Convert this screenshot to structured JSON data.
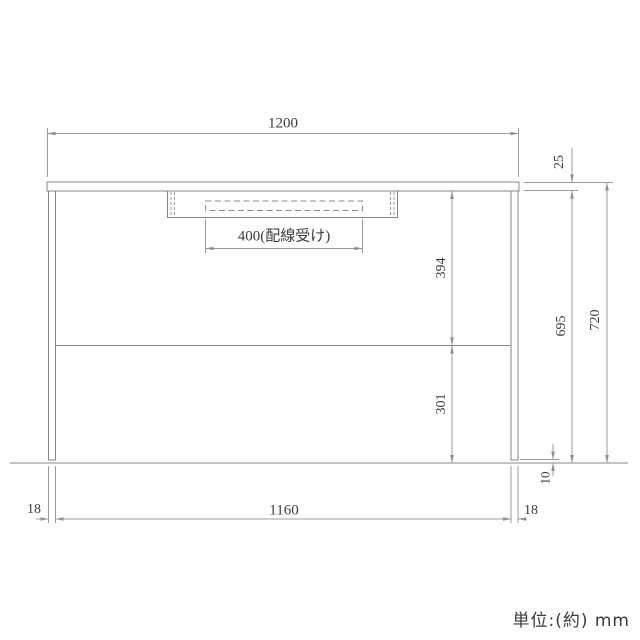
{
  "drawing": {
    "type": "furniture-dimension-diagram",
    "subject": "desk front elevation",
    "unit_note": "単位:(約) mm",
    "colors": {
      "background": "#ffffff",
      "object_lines": "#858585",
      "dimension_lines": "#9b9b9b",
      "text": "#3c3c3c"
    },
    "dimensions": {
      "top_width": "1200",
      "top_thickness": "25",
      "cable_tray": "400(配線受け)",
      "under_top_to_crossbar": "394",
      "under_top_to_floor": "695",
      "total_height": "720",
      "crossbar_to_floor": "301",
      "adjuster_clearance": "10",
      "left_leg_thickness": "18",
      "inner_width": "1160",
      "right_leg_thickness": "18"
    }
  }
}
